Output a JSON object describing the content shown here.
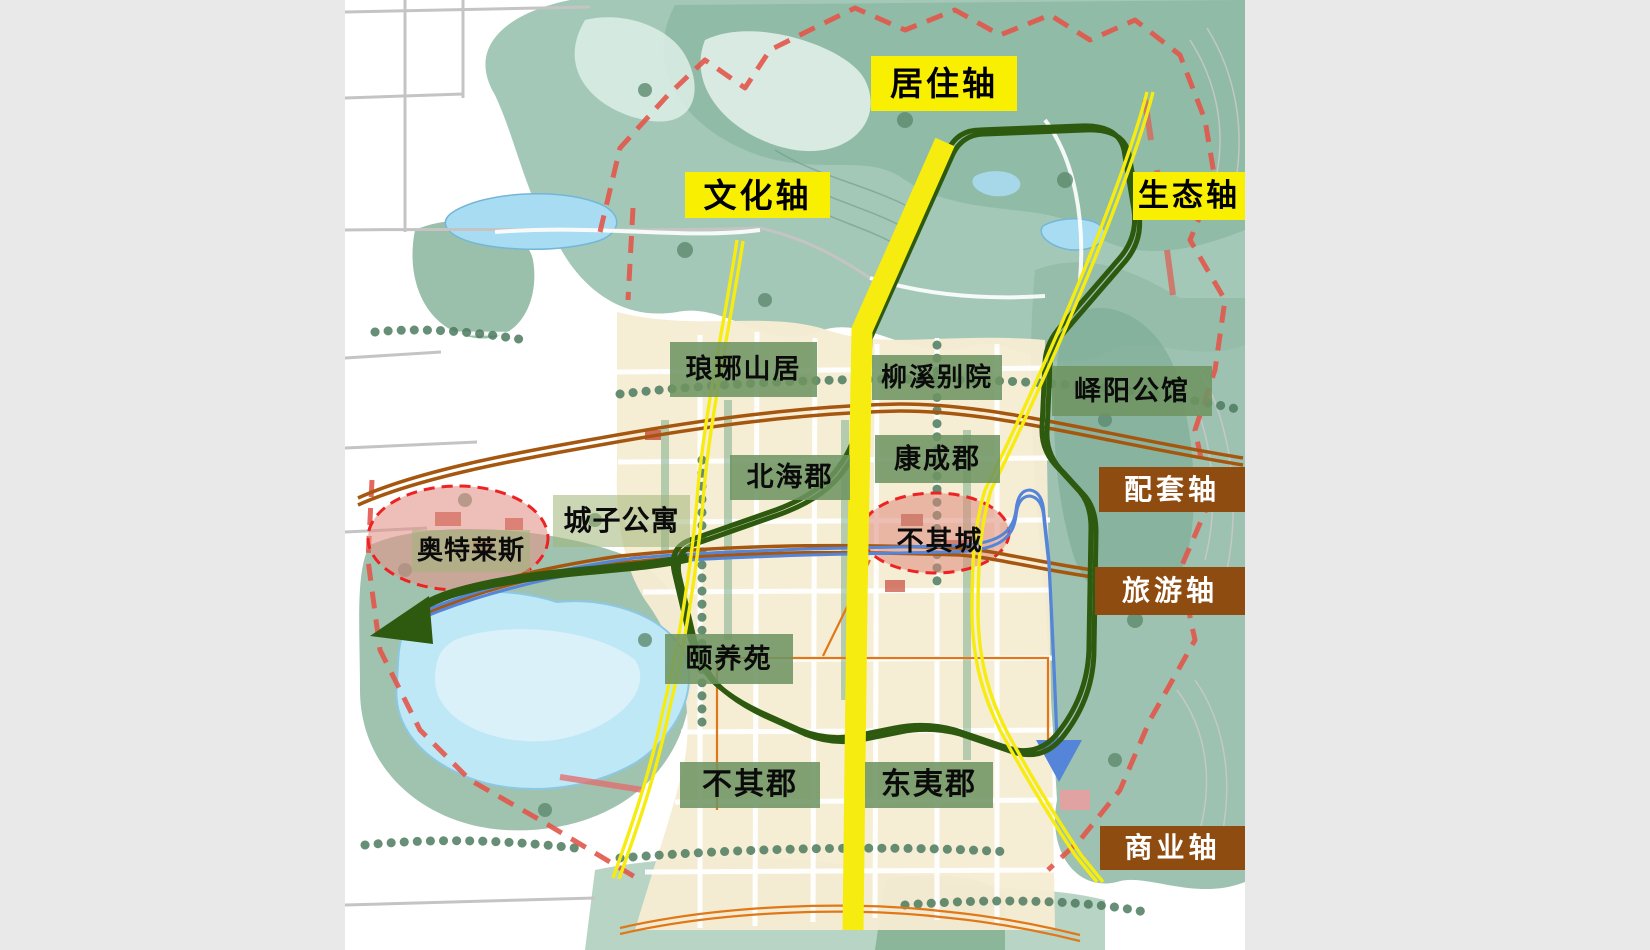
{
  "page": {
    "background": "#e9e9e9",
    "description_colors": {
      "axis_yellow": "#f8f000",
      "loop_road_green": "#2e5a0f",
      "service_road_brown": "#a6570f",
      "tour_route_blue": "#5585d8",
      "boundary_red": "#e2574b",
      "district_label_green": "rgba(110,148,98,0.87)",
      "axis_label_brown": "#8f4c10",
      "lake_blue": "#bfe8f7",
      "hills_green": "#9cc3b1",
      "urban_cream": "#f6ecd3"
    }
  },
  "labels": {
    "residential_axis": "居住轴",
    "cultural_axis": "文化轴",
    "ecological_axis": "生态轴",
    "supporting_axis": "配套轴",
    "tourism_axis": "旅游轴",
    "commercial_axis": "商业轴",
    "langya_mountain_residence": "琅琊山居",
    "liuxi_courtyard": "柳溪别院",
    "yiyang_mansion": "峄阳公馆",
    "beihai_county": "北海郡",
    "kangcheng_county": "康成郡",
    "chengzi_apartments": "城子公寓",
    "outlets": "奥特莱斯",
    "buqi_city": "不其城",
    "yiyang_garden": "颐养苑",
    "buqi_county": "不其郡",
    "dongyi_county": "东夷郡"
  }
}
